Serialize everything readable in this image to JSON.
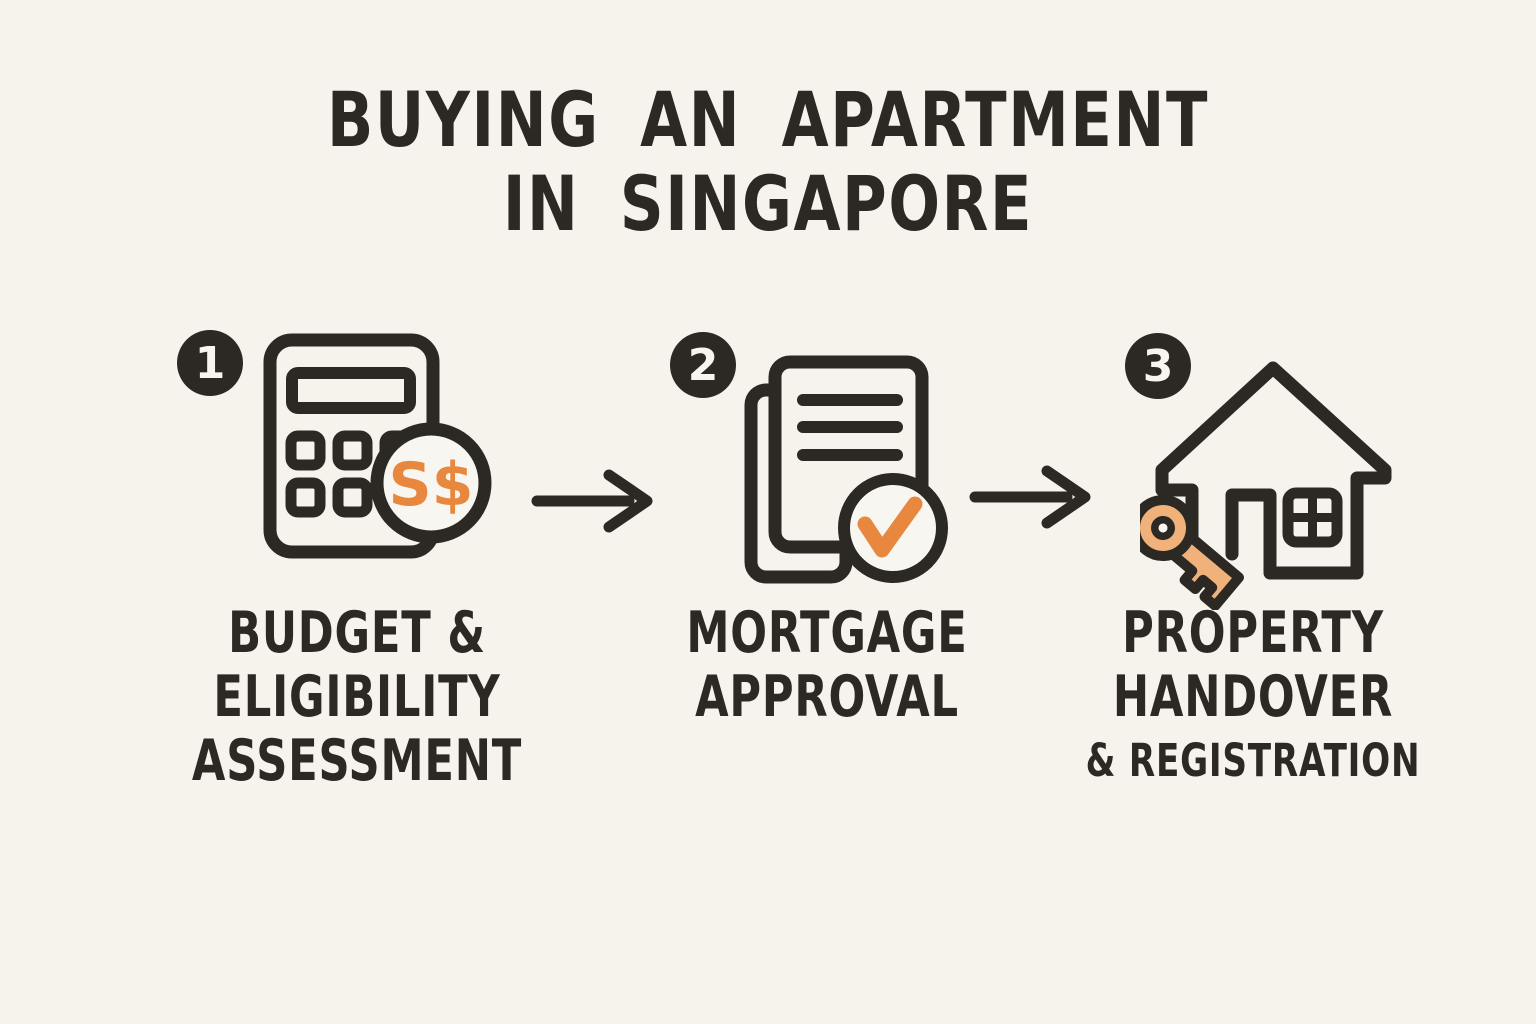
{
  "title": {
    "line1": "BUYING AN APARTMENT",
    "line2": "IN SINGAPORE"
  },
  "steps": [
    {
      "number": "1",
      "icon": "calculator-sgd-coin-icon",
      "coin_text": "S$",
      "label": [
        "BUDGET &",
        "ELIGIBILITY",
        "ASSESSMENT"
      ]
    },
    {
      "number": "2",
      "icon": "documents-checkmark-icon",
      "label": [
        "MORTGAGE",
        "APPROVAL"
      ]
    },
    {
      "number": "3",
      "icon": "house-key-icon",
      "label": [
        "PROPERTY",
        "HANDOVER",
        "& REGISTRATION"
      ]
    }
  ],
  "connector_icon": "arrow-right-icon",
  "colors": {
    "paper": "#f5f3ec",
    "ink": "#2c2925",
    "accent_orange": "#e8873e",
    "key_tan": "#f0b17a",
    "coin_fill": "#f8f6f0",
    "badge_fill": "#2c2925",
    "badge_text": "#f7f5ee"
  }
}
